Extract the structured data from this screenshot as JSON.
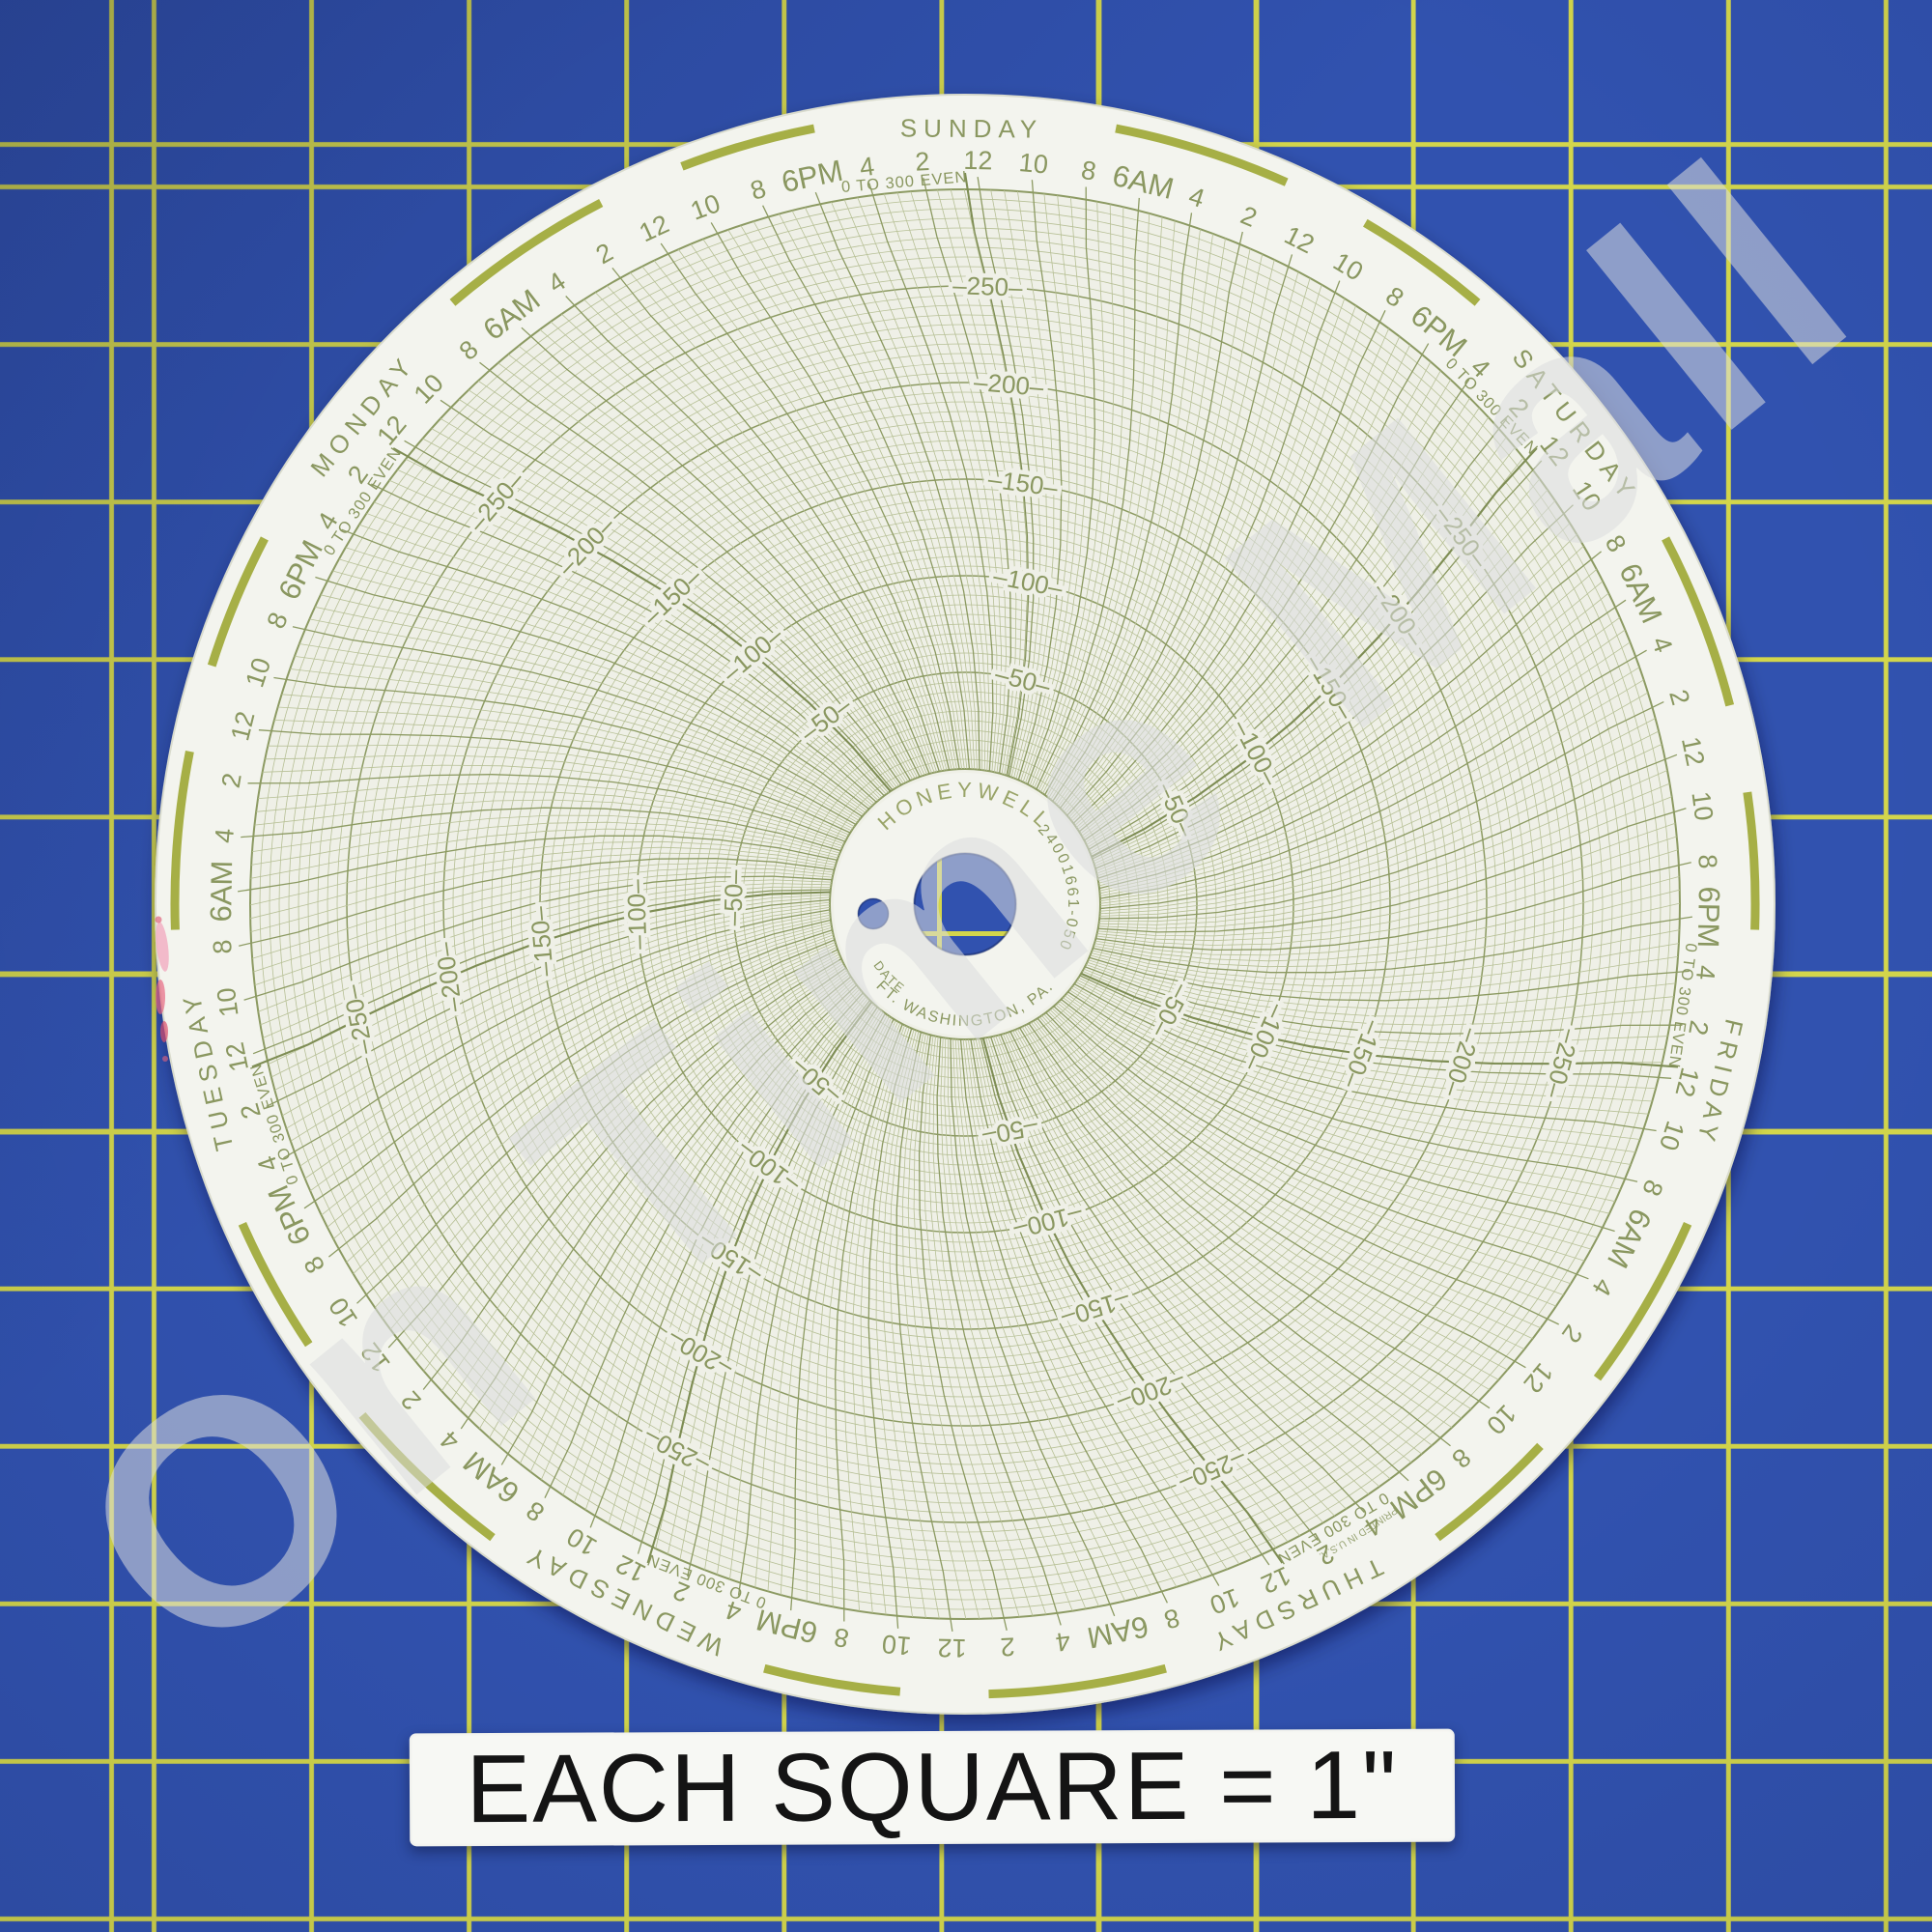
{
  "watermark": {
    "text": "On Time Mall"
  },
  "caption": {
    "text": "EACH SQUARE = 1\""
  },
  "mat": {
    "blue": "#3152af",
    "yellow_line": "#d3d64b"
  },
  "chart_data": {
    "type": "polar-grid",
    "description": "Blank Honeywell 7-day circular chart recorder paper (no trace plotted), photographed on a 1-inch blue grid cutting mat",
    "brand": "HONEYWELL",
    "part_number": "24001661-050",
    "center_text": {
      "date_label": "DATE",
      "origin": "FT. WASHINGTON, PA."
    },
    "rim_text": {
      "scale_note": "0 TO 300 EVEN",
      "printed_note": "PRINTED IN U.S.A."
    },
    "value_axis": {
      "min": 0,
      "max": 300,
      "major_step": 50,
      "minor_step": 5,
      "labeled_rings": [
        50,
        100,
        150,
        200,
        250
      ]
    },
    "time_axis": {
      "days_clockwise_from_top": [
        "SUNDAY",
        "SATURDAY",
        "FRIDAY",
        "THURSDAY",
        "WEDNESDAY",
        "TUESDAY",
        "MONDAY"
      ],
      "labels_per_day_clockwise": [
        "12",
        "10",
        "8",
        "6AM",
        "4",
        "2",
        "12",
        "10",
        "8",
        "6PM",
        "4",
        "2"
      ],
      "label_step_hours": 2
    },
    "colors": {
      "grid_major": "#8c9a62",
      "grid_minor": "#b7c096",
      "grid_boundary": "#7e8d54",
      "text": "#8a9760",
      "day_marker_arc": "#a6af46",
      "paper": "#f3f4ee",
      "grid_bg": "#eff0e7",
      "edge_smudge": "#e7647f",
      "mat_blue": "#3152af",
      "mat_yellow": "#d3d64b"
    }
  }
}
